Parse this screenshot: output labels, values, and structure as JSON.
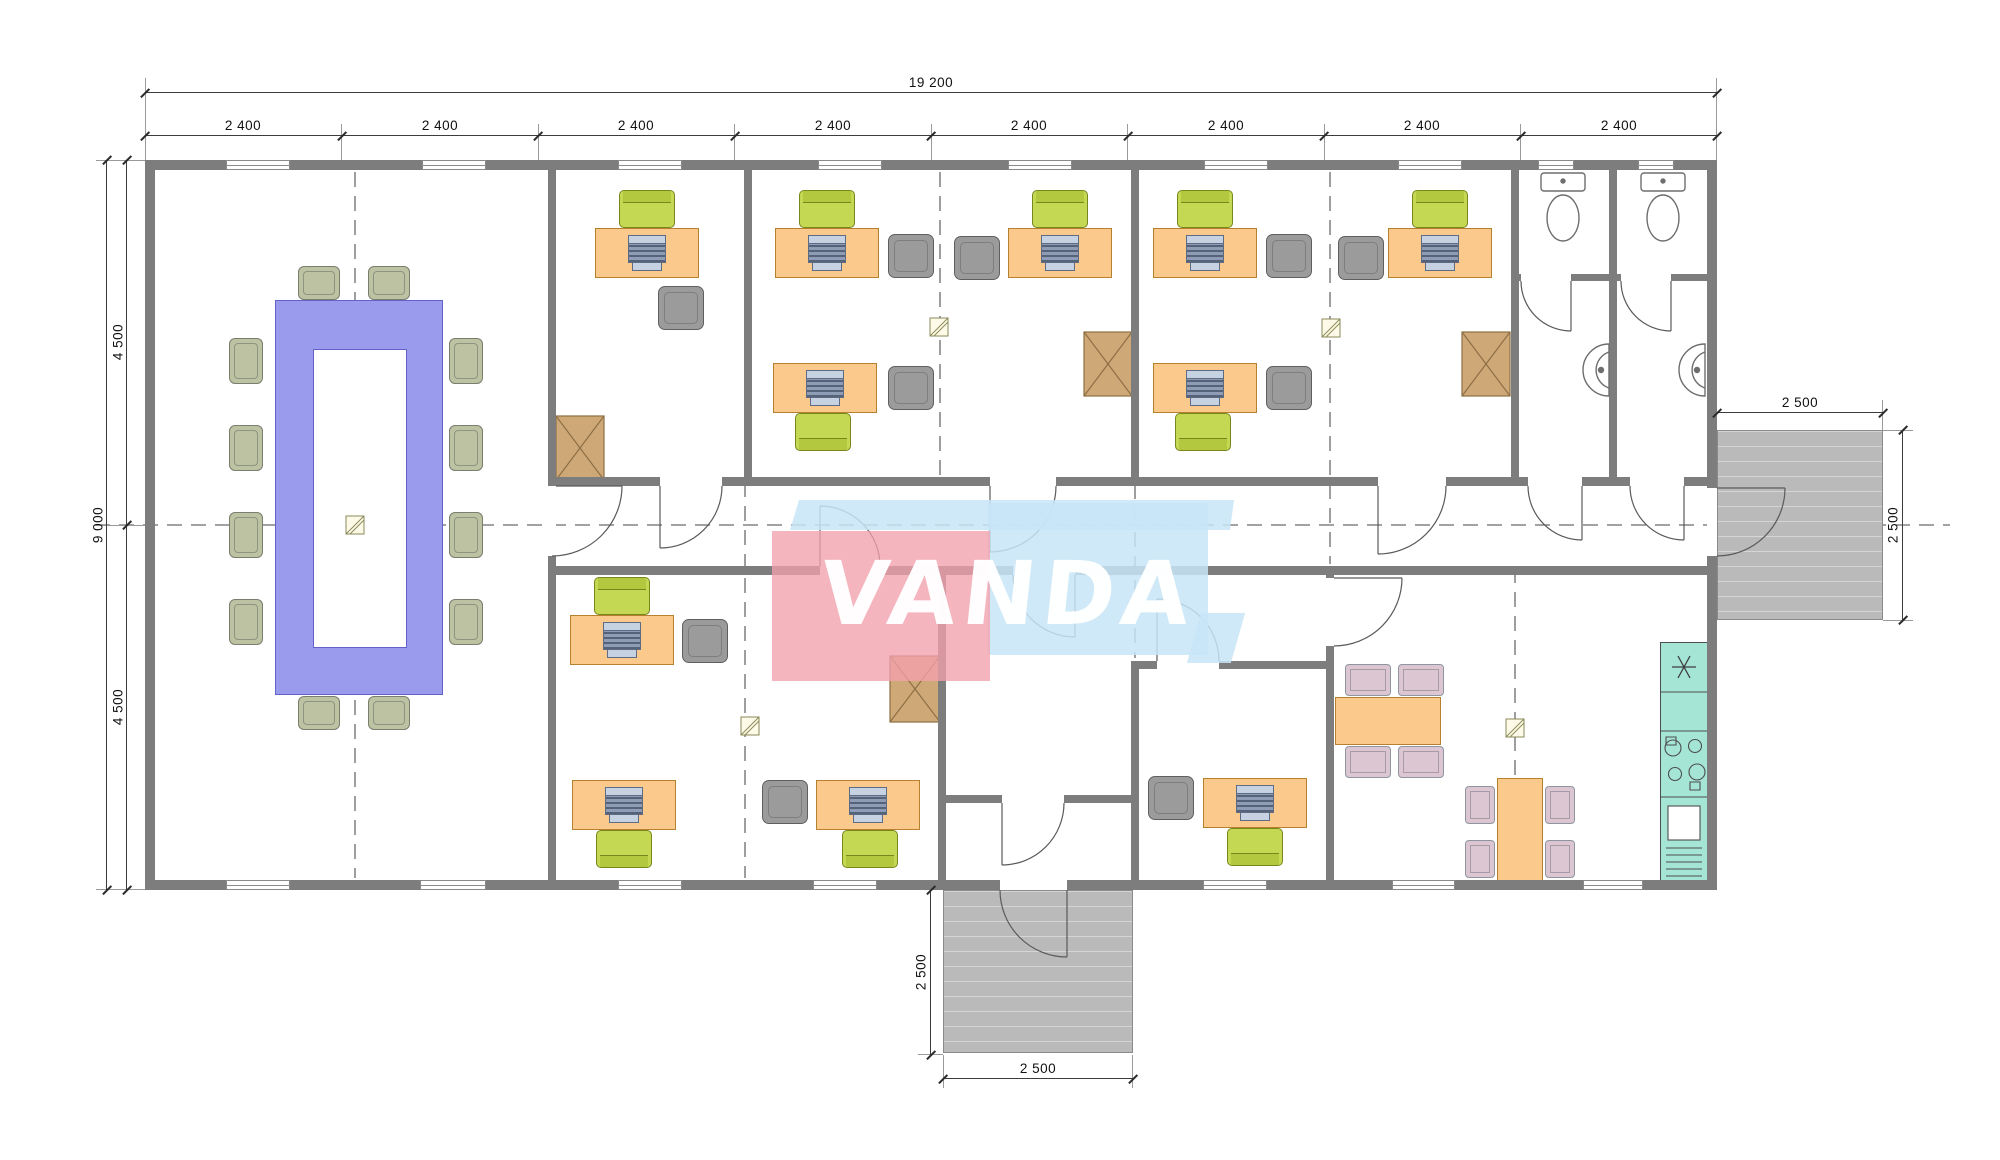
{
  "dimensions": {
    "total_width_label": "19 200",
    "module_labels": [
      "2 400",
      "2 400",
      "2 400",
      "2 400",
      "2 400",
      "2 400",
      "2 400",
      "2 400"
    ],
    "left_total_label": "9 000",
    "left_upper_label": "4 500",
    "left_lower_label": "4 500",
    "right_porch_width_label": "2 500",
    "right_porch_depth_label": "2 500",
    "bottom_porch_depth_label": "2 500",
    "bottom_porch_width_label": "2 500"
  },
  "watermark": {
    "text": "VANDA",
    "pink_color": "#f2a0ac",
    "blue_color": "#c7e5f7"
  },
  "colors": {
    "wall": "#7d7d7d",
    "desk": "#fbc98c",
    "task_chair": "#c5d854",
    "guest_chair": "#9b9b9b",
    "conference_table": "#9b9bee",
    "conference_chair": "#bdc2a3",
    "cabinet": "#cfa878",
    "dining_chair": "#dbc6d2",
    "kitchen_counter": "#a5e5d5",
    "deck": "#bababa"
  }
}
